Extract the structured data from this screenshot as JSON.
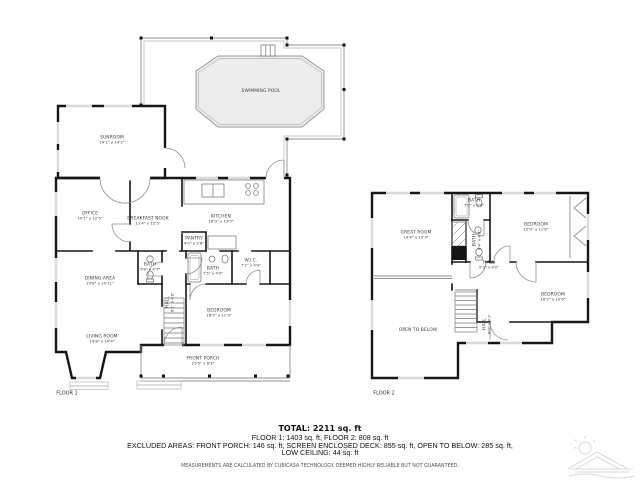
{
  "floor1": {
    "label": "FLOOR 1",
    "rooms": {
      "swimming_pool": {
        "name": "SWIMMING POOL",
        "dims": ""
      },
      "sunroom": {
        "name": "SUNROOM",
        "dims": "14'2\" x 14'2\""
      },
      "office": {
        "name": "OFFICE",
        "dims": "10'1\" x 12'5\""
      },
      "breakfast_nook": {
        "name": "BREAKFAST NOOK",
        "dims": "11'4\" x 12'5\""
      },
      "kitchen": {
        "name": "KITCHEN",
        "dims": "16'9\" x 13'5\""
      },
      "pantry": {
        "name": "PANTRY",
        "dims": "4'0\" x 2'8\""
      },
      "bath_small": {
        "name": "BATH",
        "dims": "5'6\" x 4'7\""
      },
      "bath_main": {
        "name": "BATH",
        "dims": "7'5\" x 4'9\""
      },
      "wic": {
        "name": "W.I.C.",
        "dims": "7'2\" x 4'9\""
      },
      "dining": {
        "name": "DINING AREA",
        "dims": "14'8\" x 10'11\""
      },
      "living": {
        "name": "LIVING ROOM",
        "dims": "14'8\" x 14'4\""
      },
      "hall": {
        "name": "HALL",
        "dims": "8'1\" x 4'8\""
      },
      "bedroom": {
        "name": "BEDROOM",
        "dims": "16'0\" x 11'9\""
      },
      "front_porch": {
        "name": "FRONT PORCH",
        "dims": "23'5\" x 6'3\""
      }
    }
  },
  "floor2": {
    "label": "FLOOR 2",
    "rooms": {
      "great_room": {
        "name": "GREAT ROOM",
        "dims": "14'4\" x 15'3\""
      },
      "bath_top": {
        "name": "BATH",
        "dims": "7'0\" x 4'0\""
      },
      "bath_mid": {
        "name": "BATH",
        "dims": "8'4\" x 4'8\""
      },
      "bedroom_right": {
        "name": "BEDROOM",
        "dims": "15'9\" x 11'6\""
      },
      "hall": {
        "name": "HALL",
        "dims": "5'3\" x 4'2\""
      },
      "bedroom_bottom": {
        "name": "BEDROOM",
        "dims": "16'2\" x 10'6\""
      },
      "stair_hall": {
        "name": "HALL",
        "dims": "8'0\" x 4'1\""
      },
      "open_to_below": {
        "name": "OPEN TO BELOW",
        "dims": ""
      }
    }
  },
  "summary": {
    "total": "TOTAL: 2211 sq. ft",
    "line1": "FLOOR 1: 1403 sq. ft, FLOOR 2: 808 sq. ft",
    "line2": "EXCLUDED AREAS: FRONT PORCH: 146 sq. ft, SCREEN ENCLOSED DECK: 855 sq. ft, OPEN TO BELOW: 285 sq. ft,",
    "line3": "LOW CEILING: 44 sq. ft",
    "disclaimer": "MEASUREMENTS ARE CALCULATED BY CUBICASA TECHNOLOGY. DEEMED HIGHLY RELIABLE BUT NOT GUARANTEED."
  }
}
